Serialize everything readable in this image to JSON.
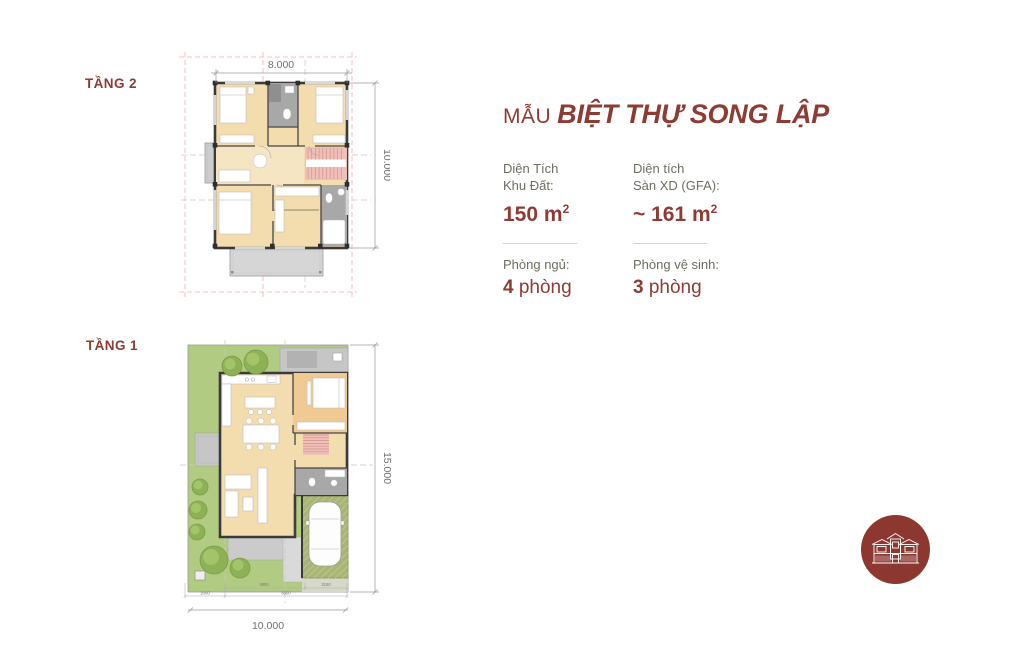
{
  "floor2": {
    "label": "TẦNG 2",
    "dim_width": "8.000",
    "dim_height": "10.000"
  },
  "floor1": {
    "label": "TẦNG 1",
    "dim_width": "10.000",
    "dim_height": "15.000",
    "sub_dims": [
      "4800",
      "3190",
      "2000",
      "8000"
    ]
  },
  "info": {
    "title_prefix": "MẪU",
    "title_main": "BIỆT THỰ SONG LẬP",
    "specs": [
      {
        "label_line1": "Diện Tích",
        "label_line2": "Khu Đất:",
        "value": "150",
        "unit": " m",
        "sup": "2"
      },
      {
        "label_line1": "Diện tích",
        "label_line2": "Sàn XD (GFA):",
        "value": "~ 161",
        "unit": " m",
        "sup": "2"
      }
    ],
    "rooms": [
      {
        "label": "Phòng ngủ:",
        "value": "4",
        "unit": " phòng"
      },
      {
        "label": "Phòng vệ sinh:",
        "value": "3",
        "unit": " phòng"
      }
    ]
  },
  "logo": {
    "icon": "duplex-villa-house-icon"
  },
  "colors": {
    "brand_red": "#8e3b33",
    "label_gray": "#6d6d60",
    "dim_gray": "#707070",
    "plan_tan": "#f3dcae",
    "bedroom_tan": "#f0ca92",
    "stair_pink": "#efbfb8",
    "bath_gray": "#a8a8a8",
    "wall_dark": "#3a3a3a",
    "garden_green": "#b2cb82",
    "tree_green": "#8db155",
    "garage_olive": "#a8b573",
    "patio_gray": "#c6c6c6",
    "guide_pink": "#efb3ae",
    "logo_bg": "#8c372f"
  }
}
